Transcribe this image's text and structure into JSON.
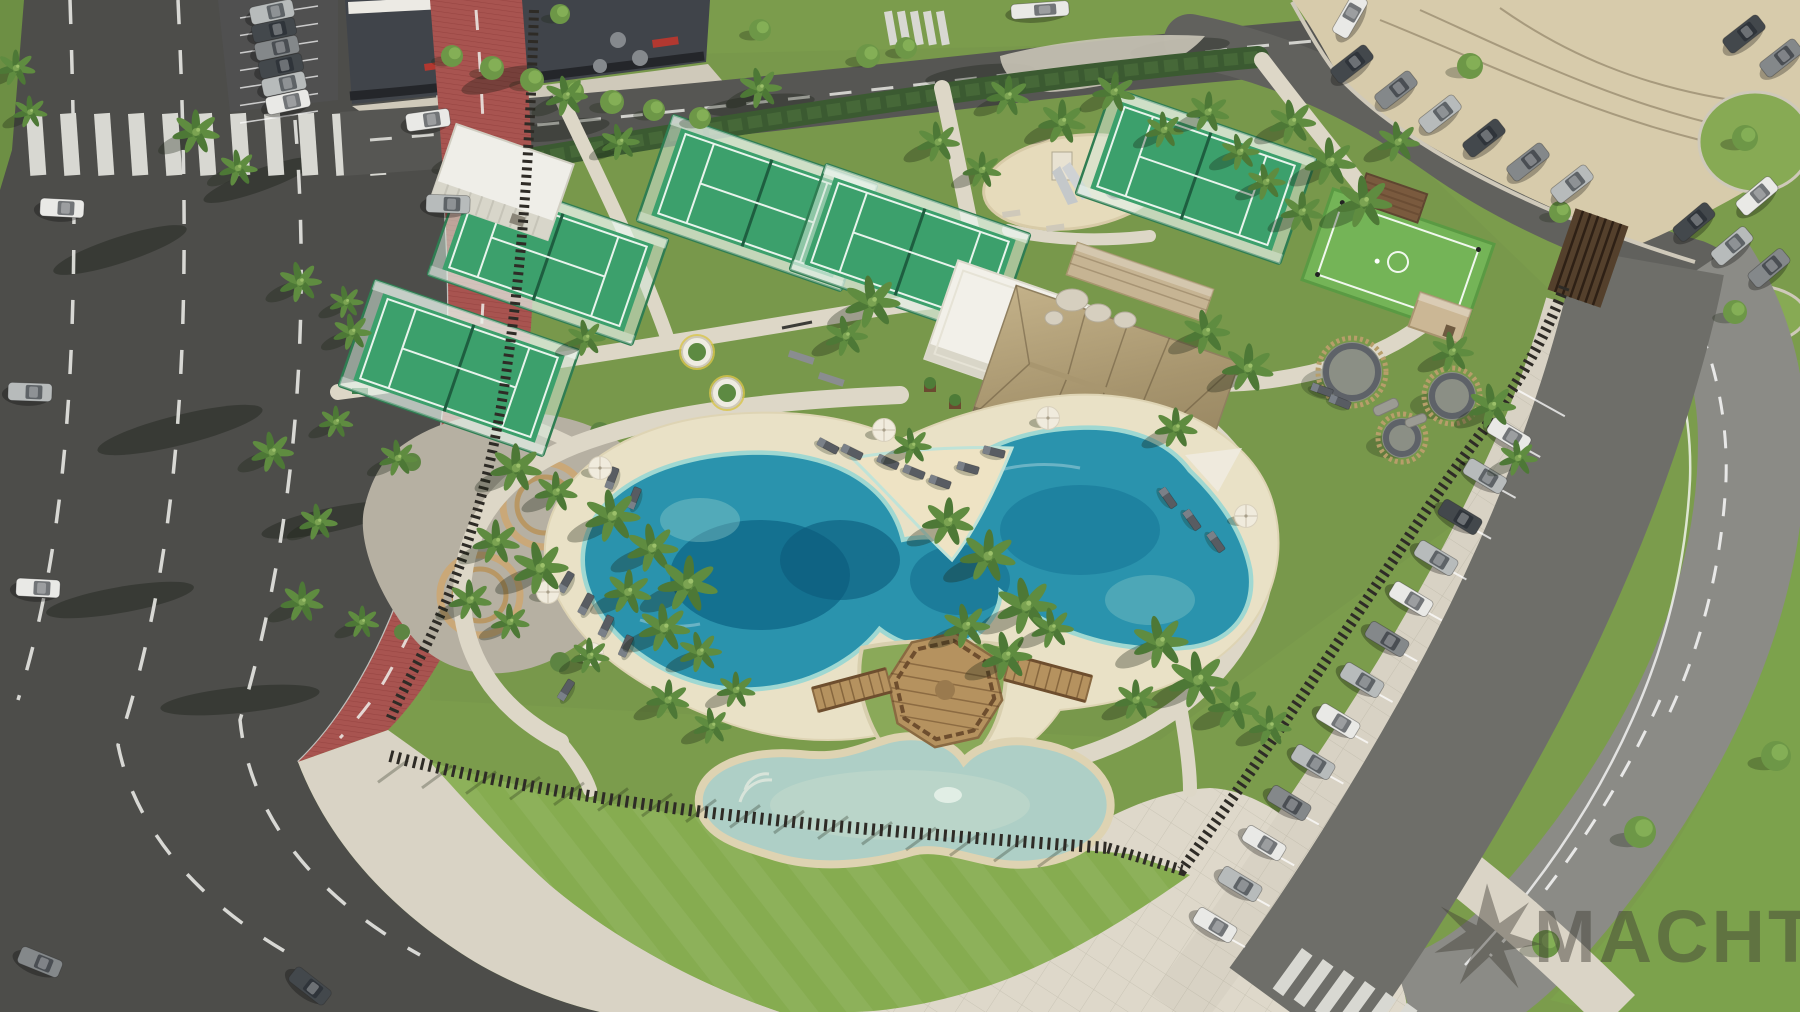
{
  "watermark": {
    "text": "MACHT",
    "logo": "starburst-logo-icon",
    "color": "#3e3c34",
    "opacity": 0.48
  },
  "palette": {
    "grass": "#7b9c4c",
    "grass_bright": "#86ac50",
    "road_dark": "#4d4d4a",
    "road_light": "#8b8b86",
    "bike_lane": "#a85450",
    "sidewalk": "#d9d3c5",
    "plaza": "#ded8ca",
    "sand_lot": "#d7cbab",
    "pool_deep": "#0e6587",
    "pool_mid": "#2a93ad",
    "pool_shallow": "#49b0bc",
    "pool_rim": "#9fd8d2",
    "kids_pool": "#aecfc6",
    "beach_sand": "#e9e1c6",
    "thatch": "#b4a27c",
    "court_green": "#3ca06c",
    "sport_green": "#74b457",
    "fence": "#2e2b26",
    "hedge": "#3b5a31",
    "wood": "#b5925f"
  },
  "scene": {
    "description": "Aerial 3D render of a seaside resort amenity park: lagoon pool with sandy beach and octagonal wooden deck, kids pool, thatched pool-bar pavilion, padel courts, multisport court, playground, outdoor gym, wicker lounge pods, red bike lane along a multi-lane road, and perimeter parking",
    "car_colors": {
      "white": "#e9e9e6",
      "silver": "#b7bbbb",
      "gray": "#84888a",
      "dark": "#43484c"
    },
    "palms": [
      [
        196,
        132,
        1.1
      ],
      [
        238,
        168,
        0.9
      ],
      [
        300,
        282,
        1.0
      ],
      [
        352,
        332,
        0.9
      ],
      [
        272,
        452,
        1.0
      ],
      [
        318,
        522,
        0.9
      ],
      [
        302,
        602,
        1.0
      ],
      [
        362,
        622,
        0.8
      ],
      [
        16,
        68,
        0.9
      ],
      [
        30,
        112,
        0.8
      ],
      [
        566,
        96,
        1.0
      ],
      [
        620,
        142,
        0.9
      ],
      [
        760,
        88,
        1.0
      ],
      [
        586,
        338,
        0.9
      ],
      [
        346,
        302,
        0.8
      ],
      [
        398,
        458,
        0.9
      ],
      [
        336,
        422,
        0.8
      ],
      [
        516,
        468,
        1.2
      ],
      [
        556,
        492,
        1.0
      ],
      [
        496,
        542,
        1.1
      ],
      [
        540,
        568,
        1.3
      ],
      [
        470,
        600,
        1.0
      ],
      [
        510,
        622,
        0.9
      ],
      [
        612,
        516,
        1.3
      ],
      [
        652,
        548,
        1.2
      ],
      [
        688,
        584,
        1.4
      ],
      [
        628,
        592,
        1.1
      ],
      [
        664,
        628,
        1.2
      ],
      [
        700,
        652,
        1.0
      ],
      [
        590,
        656,
        0.9
      ],
      [
        668,
        700,
        1.0
      ],
      [
        712,
        726,
        0.9
      ],
      [
        948,
        522,
        1.2
      ],
      [
        988,
        556,
        1.3
      ],
      [
        1026,
        606,
        1.4
      ],
      [
        966,
        626,
        1.1
      ],
      [
        1006,
        656,
        1.2
      ],
      [
        1052,
        628,
        1.0
      ],
      [
        872,
        302,
        1.3
      ],
      [
        846,
        336,
        1.0
      ],
      [
        912,
        446,
        0.9
      ],
      [
        1206,
        332,
        1.1
      ],
      [
        1248,
        368,
        1.2
      ],
      [
        1176,
        428,
        1.0
      ],
      [
        938,
        142,
        1.0
      ],
      [
        982,
        170,
        0.9
      ],
      [
        1008,
        96,
        1.0
      ],
      [
        1062,
        122,
        1.1
      ],
      [
        1114,
        92,
        1.0
      ],
      [
        1164,
        130,
        0.9
      ],
      [
        1208,
        112,
        1.0
      ],
      [
        1240,
        152,
        0.9
      ],
      [
        1292,
        122,
        1.1
      ],
      [
        1330,
        162,
        1.2
      ],
      [
        1364,
        202,
        1.3
      ],
      [
        1302,
        212,
        1.0
      ],
      [
        1266,
        182,
        0.9
      ],
      [
        1398,
        142,
        1.0
      ],
      [
        1452,
        352,
        1.0
      ],
      [
        1492,
        406,
        1.1
      ],
      [
        1518,
        458,
        0.9
      ],
      [
        1160,
        642,
        1.3
      ],
      [
        1198,
        680,
        1.4
      ],
      [
        1234,
        706,
        1.2
      ],
      [
        1270,
        726,
        1.0
      ],
      [
        1136,
        700,
        1.0
      ],
      [
        736,
        690,
        0.9
      ]
    ],
    "trees": [
      [
        452,
        56,
        11
      ],
      [
        492,
        68,
        12
      ],
      [
        532,
        80,
        12
      ],
      [
        572,
        92,
        12
      ],
      [
        612,
        102,
        12
      ],
      [
        654,
        110,
        11
      ],
      [
        700,
        118,
        11
      ],
      [
        868,
        56,
        12
      ],
      [
        906,
        48,
        11
      ],
      [
        760,
        30,
        11
      ],
      [
        560,
        14,
        10
      ],
      [
        1470,
        66,
        13
      ],
      [
        1560,
        212,
        11
      ],
      [
        1745,
        138,
        13
      ],
      [
        1735,
        312,
        12
      ],
      [
        1640,
        832,
        16
      ],
      [
        1546,
        944,
        14
      ],
      [
        1776,
        756,
        15
      ]
    ],
    "cars": [
      [
        62,
        208,
        3,
        "white"
      ],
      [
        30,
        392,
        2,
        "silver"
      ],
      [
        38,
        588,
        3,
        "white"
      ],
      [
        40,
        962,
        22,
        "gray"
      ],
      [
        310,
        986,
        38,
        "dark"
      ],
      [
        428,
        120,
        -8,
        "white"
      ],
      [
        448,
        204,
        2,
        "silver"
      ],
      [
        272,
        12,
        -12,
        "silver"
      ],
      [
        274,
        30,
        -12,
        "dark"
      ],
      [
        277,
        48,
        -12,
        "gray"
      ],
      [
        281,
        66,
        -12,
        "dark"
      ],
      [
        284,
        84,
        -12,
        "silver"
      ],
      [
        288,
        102,
        -12,
        "white"
      ],
      [
        1040,
        10,
        -4,
        "white",
        58,
        15
      ],
      [
        1352,
        64,
        -38,
        "dark"
      ],
      [
        1396,
        90,
        -38,
        "gray"
      ],
      [
        1440,
        114,
        -38,
        "silver"
      ],
      [
        1484,
        138,
        -38,
        "dark"
      ],
      [
        1528,
        162,
        -38,
        "gray"
      ],
      [
        1572,
        184,
        -38,
        "silver"
      ],
      [
        1744,
        34,
        -38,
        "dark"
      ],
      [
        1781,
        58,
        -38,
        "gray"
      ],
      [
        1350,
        16,
        -60,
        "white"
      ],
      [
        1215,
        925,
        31,
        "white"
      ],
      [
        1240,
        884,
        31,
        "silver"
      ],
      [
        1264,
        843,
        31,
        "white"
      ],
      [
        1289,
        803,
        31,
        "gray"
      ],
      [
        1313,
        762,
        31,
        "silver"
      ],
      [
        1338,
        721,
        31,
        "white"
      ],
      [
        1362,
        680,
        31,
        "silver"
      ],
      [
        1387,
        639,
        31,
        "gray"
      ],
      [
        1411,
        599,
        31,
        "white"
      ],
      [
        1436,
        558,
        31,
        "silver"
      ],
      [
        1460,
        517,
        31,
        "dark"
      ],
      [
        1485,
        476,
        31,
        "silver"
      ],
      [
        1509,
        435,
        31,
        "white"
      ],
      [
        1694,
        222,
        -40,
        "dark"
      ],
      [
        1732,
        246,
        -40,
        "silver"
      ],
      [
        1769,
        268,
        -40,
        "gray"
      ],
      [
        1757,
        196,
        -40,
        "white"
      ]
    ],
    "loungers": [
      [
        612,
        478,
        -70
      ],
      [
        634,
        498,
        -68
      ],
      [
        566,
        582,
        -60
      ],
      [
        586,
        604,
        -62
      ],
      [
        606,
        626,
        -64
      ],
      [
        626,
        646,
        -66
      ],
      [
        828,
        446,
        28
      ],
      [
        852,
        452,
        26
      ],
      [
        888,
        462,
        24
      ],
      [
        914,
        472,
        22
      ],
      [
        940,
        482,
        20
      ],
      [
        968,
        468,
        16
      ],
      [
        994,
        452,
        14
      ],
      [
        1168,
        498,
        55
      ],
      [
        1192,
        520,
        55
      ],
      [
        1216,
        542,
        55
      ],
      [
        1322,
        390,
        20
      ],
      [
        1340,
        402,
        22
      ],
      [
        566,
        690,
        -58
      ]
    ],
    "umbrellas": [
      [
        600,
        468
      ],
      [
        548,
        592
      ],
      [
        592,
        654
      ],
      [
        884,
        430
      ],
      [
        1048,
        418
      ],
      [
        1246,
        516
      ]
    ],
    "pods": [
      [
        1352,
        372,
        34
      ],
      [
        1452,
        396,
        28
      ],
      [
        1402,
        438,
        24
      ]
    ]
  }
}
